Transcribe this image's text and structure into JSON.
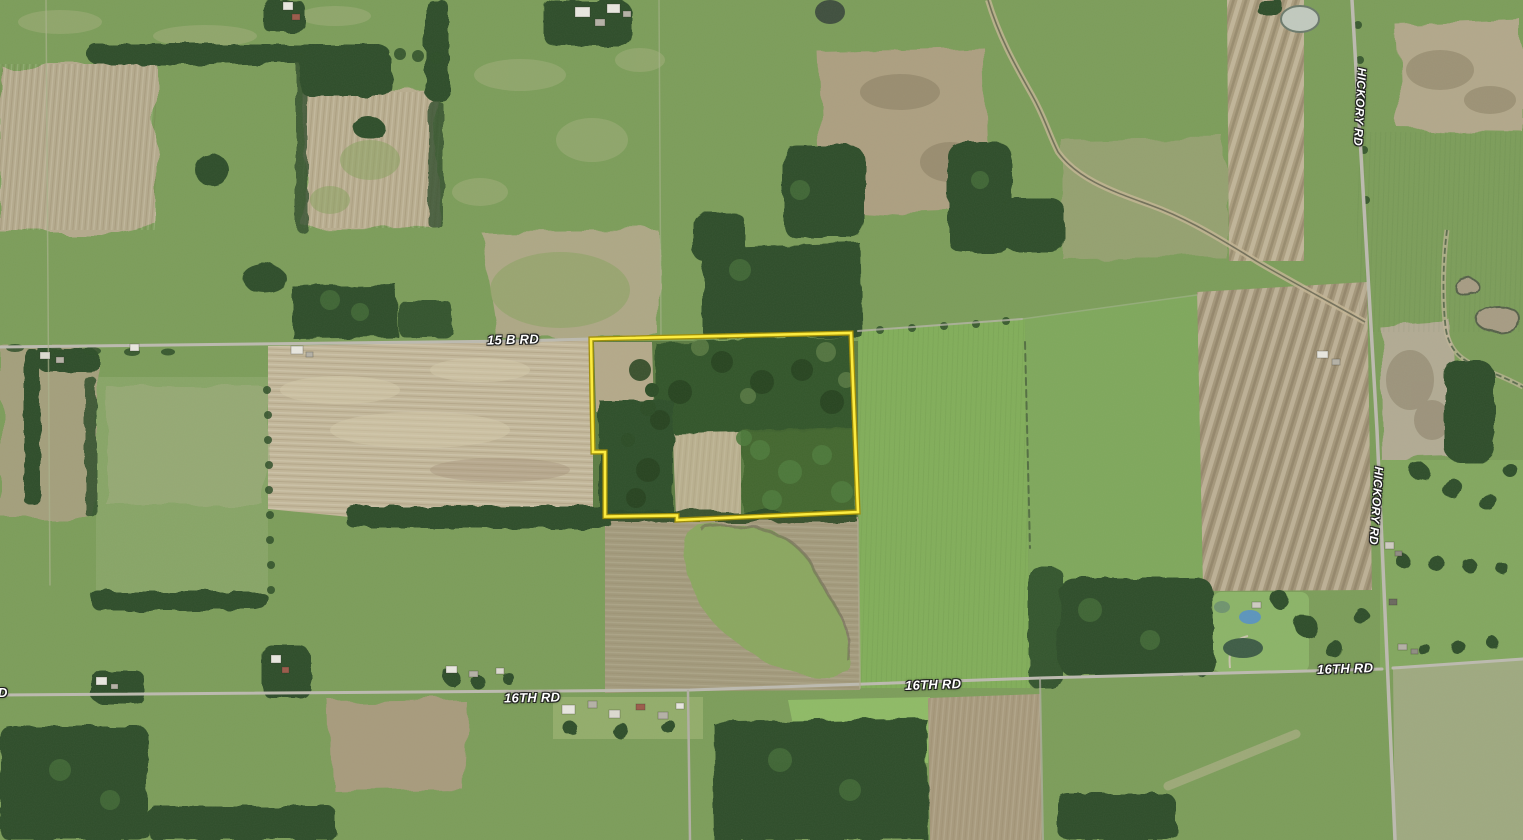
{
  "map": {
    "kind": "aerial-satellite-parcel-view",
    "labels": [
      {
        "id": "road-15b",
        "text": "15 B RD"
      },
      {
        "id": "hickory-top",
        "text": "HICKORY RD"
      },
      {
        "id": "hickory-mid",
        "text": "HICKORY RD"
      },
      {
        "id": "road-16th-partial",
        "text": "D"
      },
      {
        "id": "road-16th-left",
        "text": "16TH RD"
      },
      {
        "id": "road-16th-mid",
        "text": "16TH RD"
      },
      {
        "id": "road-16th-right",
        "text": "16TH RD"
      }
    ],
    "parcel": {
      "outline_color": "#ffee3c",
      "outline_edge_color": "#a08c00"
    },
    "label_style": {
      "color": "#ffffff",
      "halo_color": "#1f1f1f"
    }
  }
}
